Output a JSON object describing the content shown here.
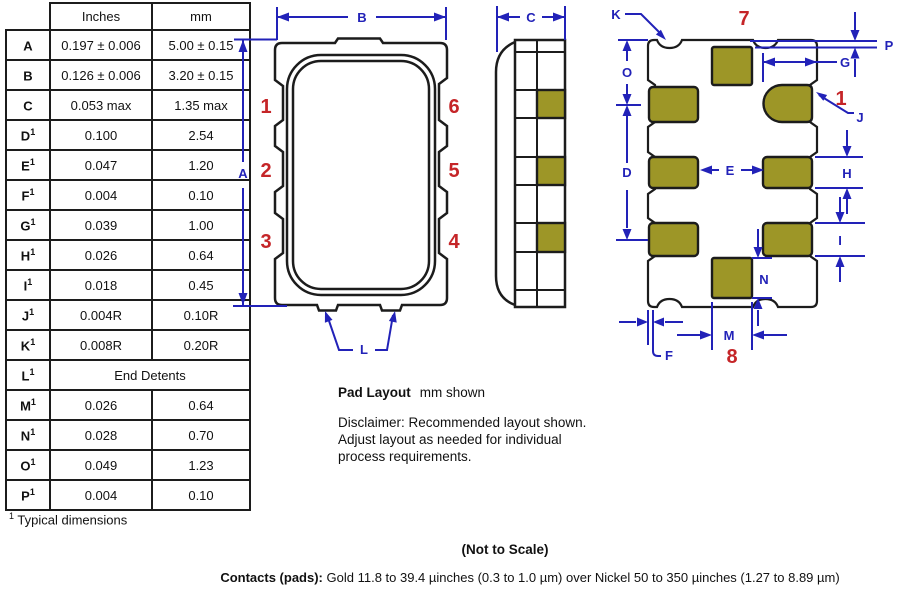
{
  "table": {
    "headers": {
      "inches": "Inches",
      "mm": "mm"
    },
    "rows": [
      {
        "label": "A",
        "sup": "",
        "inches": "0.197 ± 0.006",
        "mm": "5.00 ± 0.15"
      },
      {
        "label": "B",
        "sup": "",
        "inches": "0.126 ± 0.006",
        "mm": "3.20 ± 0.15"
      },
      {
        "label": "C",
        "sup": "",
        "inches": "0.053 max",
        "mm": "1.35 max"
      },
      {
        "label": "D",
        "sup": "1",
        "inches": "0.100",
        "mm": "2.54"
      },
      {
        "label": "E",
        "sup": "1",
        "inches": "0.047",
        "mm": "1.20"
      },
      {
        "label": "F",
        "sup": "1",
        "inches": "0.004",
        "mm": "0.10"
      },
      {
        "label": "G",
        "sup": "1",
        "inches": "0.039",
        "mm": "1.00"
      },
      {
        "label": "H",
        "sup": "1",
        "inches": "0.026",
        "mm": "0.64"
      },
      {
        "label": "I",
        "sup": "1",
        "inches": "0.018",
        "mm": "0.45"
      },
      {
        "label": "J",
        "sup": "1",
        "inches": "0.004R",
        "mm": "0.10R"
      },
      {
        "label": "K",
        "sup": "1",
        "inches": "0.008R",
        "mm": "0.20R"
      },
      {
        "label": "L",
        "sup": "1",
        "span": "End Detents"
      },
      {
        "label": "M",
        "sup": "1",
        "inches": "0.026",
        "mm": "0.64"
      },
      {
        "label": "N",
        "sup": "1",
        "inches": "0.028",
        "mm": "0.70"
      },
      {
        "label": "O",
        "sup": "1",
        "inches": "0.049",
        "mm": "1.23"
      },
      {
        "label": "P",
        "sup": "1",
        "inches": "0.004",
        "mm": "0.10"
      }
    ],
    "footnote_sup": "1",
    "footnote": "Typical dimensions"
  },
  "front_view": {
    "dim_a": "A",
    "dim_b": "B",
    "dim_l": "L",
    "pins": [
      "1",
      "2",
      "3",
      "4",
      "5",
      "6"
    ]
  },
  "side_view": {
    "dim_c": "C"
  },
  "pad_layout": {
    "pad_top": "7",
    "pad_bottom": "8",
    "pin_one": "1",
    "dims": {
      "k": "K",
      "p": "P",
      "o": "O",
      "g": "G",
      "j": "J",
      "d": "D",
      "e": "E",
      "h": "H",
      "i": "I",
      "n": "N",
      "m": "M",
      "f": "F"
    }
  },
  "notes": {
    "pad_layout_title": "Pad Layout",
    "pad_layout_subtitle": "mm shown",
    "disclaimer": [
      "Disclaimer: Recommended layout shown.",
      "Adjust layout as needed for individual",
      "process requirements."
    ],
    "not_to_scale": "(Not to Scale)",
    "contacts_label": "Contacts (pads):",
    "contacts_text": "Gold 11.8 to 39.4 µinches (0.3 to 1.0 µm) over Nickel 50 to 350 µinches (1.27 to 8.89 µm)"
  },
  "colors": {
    "dimension_blue": "#2222b8",
    "pin_red": "#c52528",
    "pad_olive": "#9d9627",
    "outline_black": "#1c1c1c"
  }
}
